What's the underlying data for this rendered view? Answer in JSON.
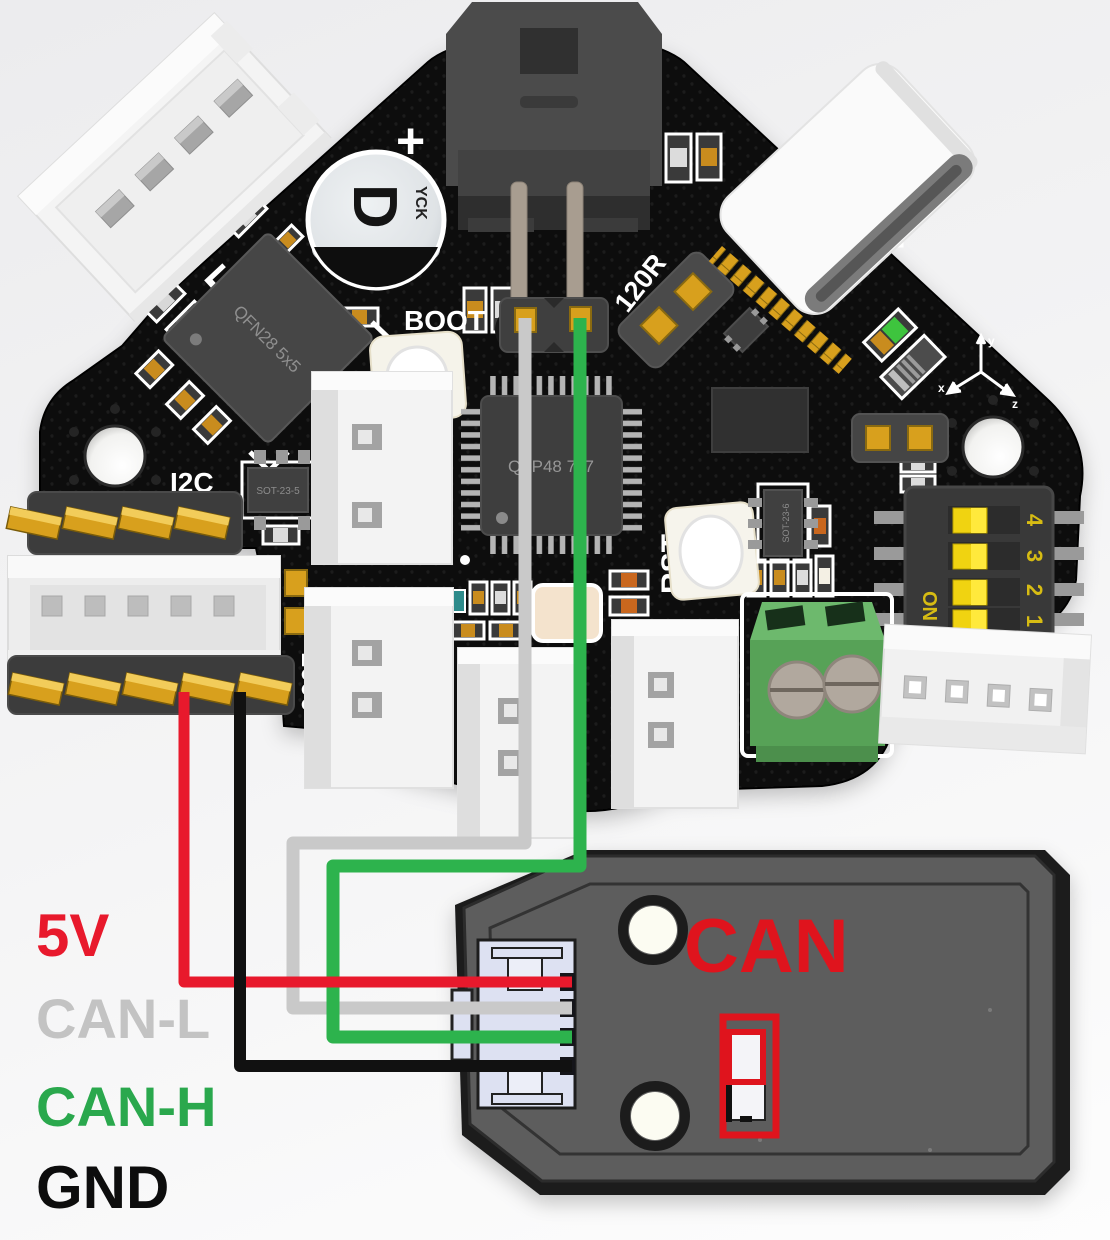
{
  "labels": {
    "v5": {
      "text": "5V",
      "color": "#e8192c"
    },
    "can_l": {
      "text": "CAN-L",
      "color": "#c3c3c3"
    },
    "can_h": {
      "text": "CAN-H",
      "color": "#2aa84d"
    },
    "gnd": {
      "text": "GND",
      "color": "#0d0d0d"
    }
  },
  "module": {
    "title": "CAN",
    "title_color": "#df141d",
    "highlight_color": "#df141d",
    "body_color": "#5d5d5d"
  },
  "wires": {
    "v5": "#e8192c",
    "can_l": "#c9c9c9",
    "can_h": "#2db34d",
    "gnd": "#111111"
  },
  "board": {
    "pcb_color": "#0b0b0b",
    "gold_color": "#d8a01d",
    "silkscreen": {
      "boot": "BOOT",
      "rst": "RST",
      "i2c": "I2C",
      "termination": "120R",
      "fuse": "1000",
      "plus": "+"
    },
    "chips": {
      "mcu": "QFP48 7x7",
      "driver": "QFN28 5x5",
      "regulator": "SOT-23-5",
      "transceiver": "SOT-23-6"
    },
    "capacitor": {
      "mark": "D",
      "vendor": "YCK"
    },
    "dip_switch": {
      "on": "ON",
      "positions": [
        "1",
        "2",
        "3",
        "4"
      ]
    },
    "axis": {
      "x": "x",
      "y": "y",
      "z": "z"
    }
  }
}
